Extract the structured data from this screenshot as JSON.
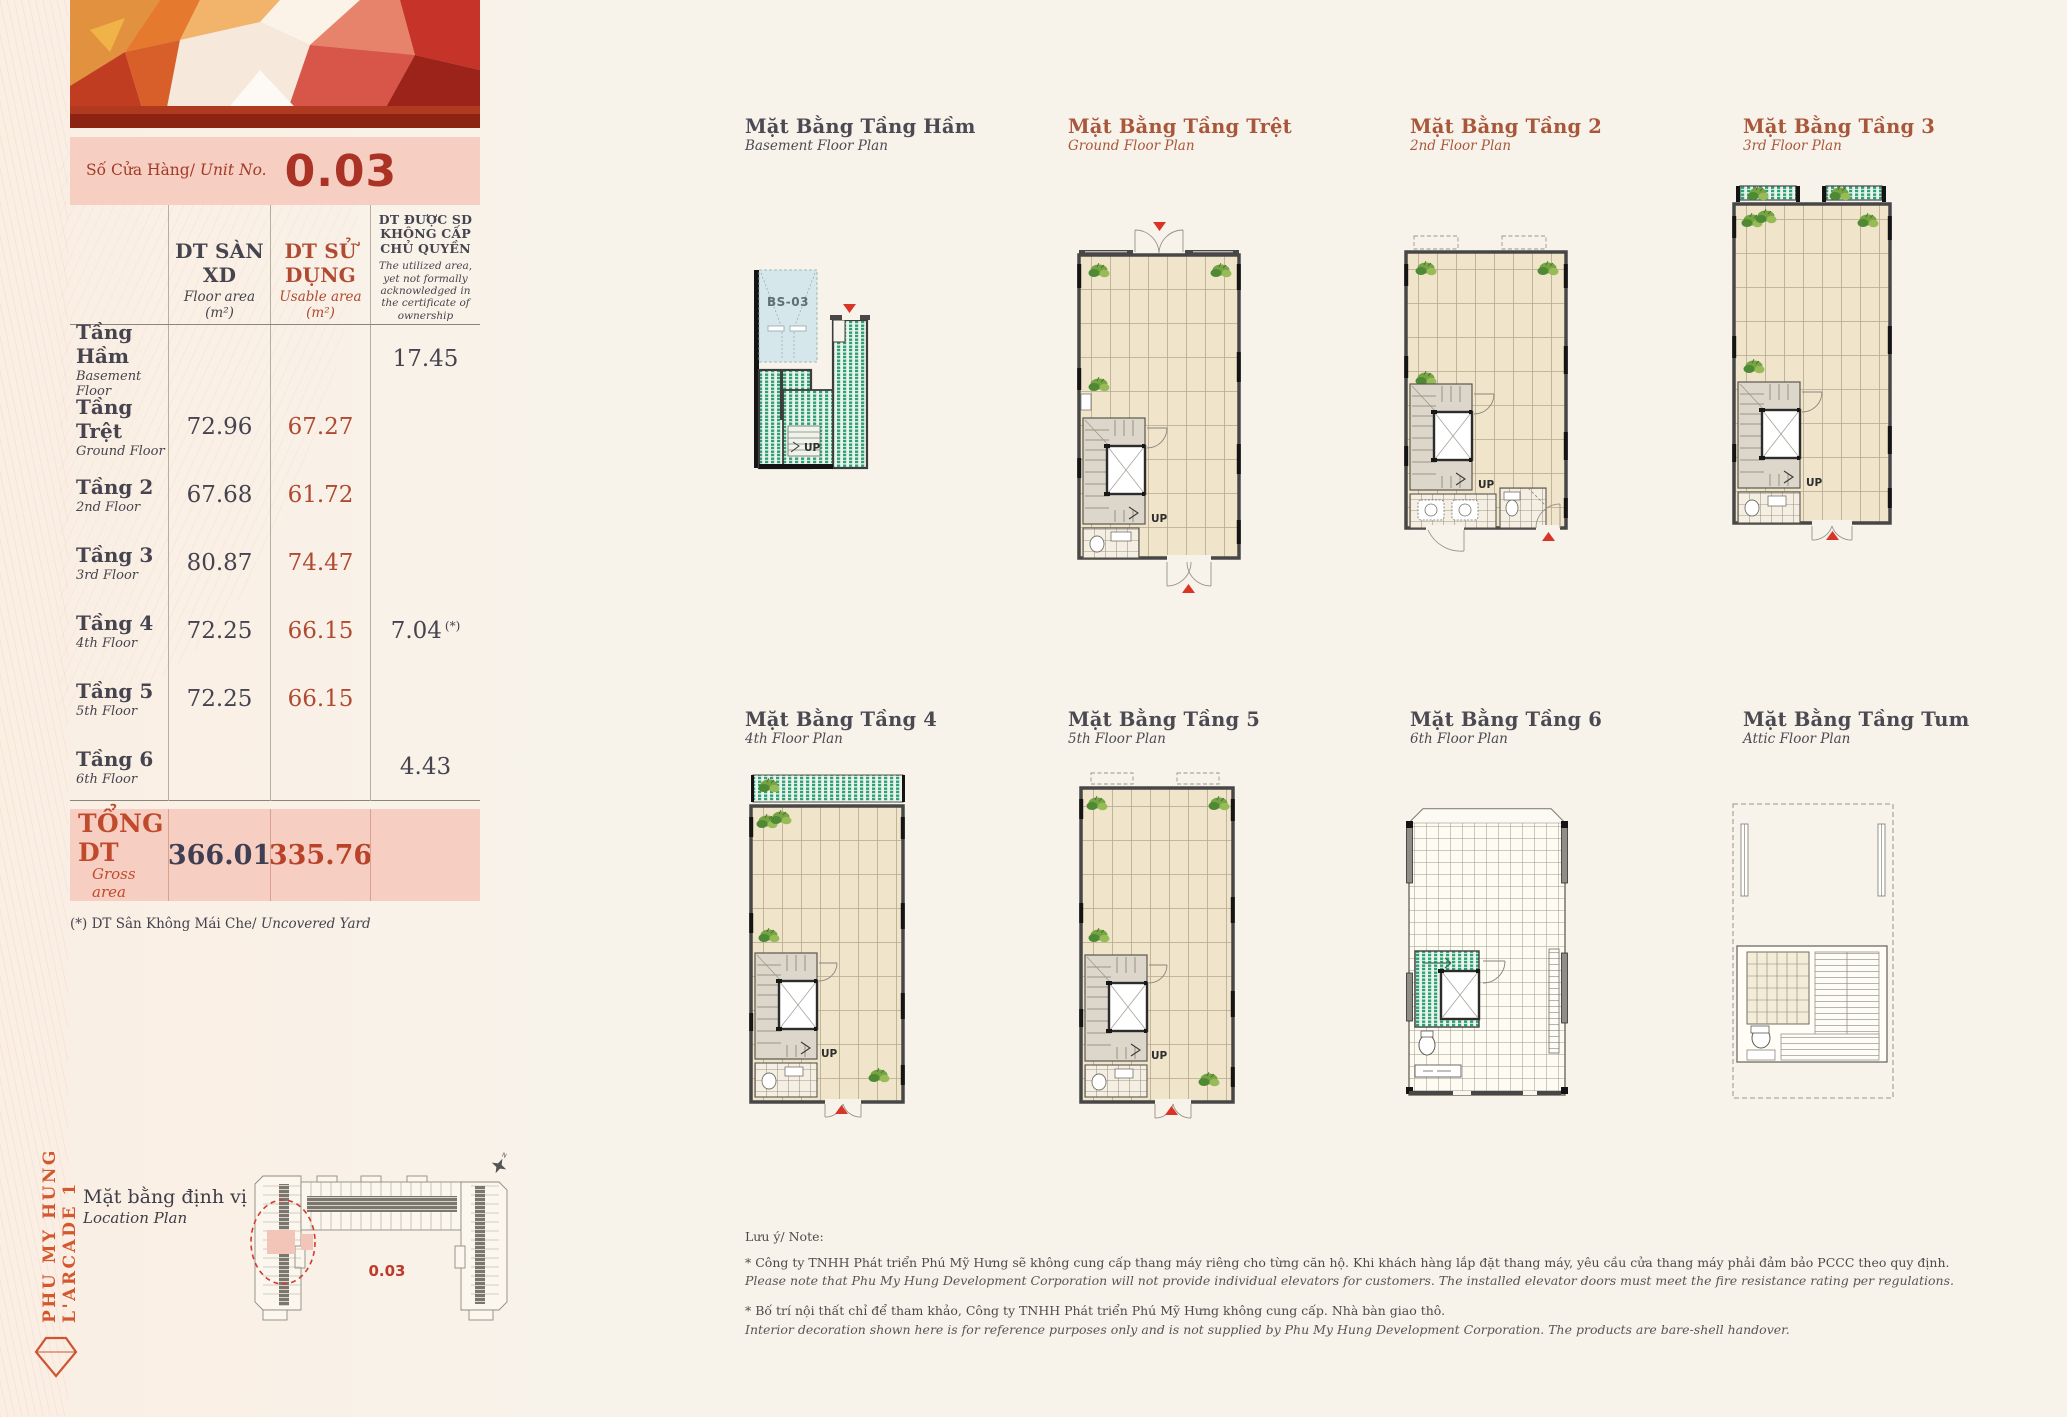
{
  "brand": {
    "vertical_text": "PHU MY HUNG L'ARCADE 1"
  },
  "unit": {
    "label_vi": "Số Cửa Hàng/",
    "label_en": "Unit No.",
    "number": "0.03"
  },
  "table": {
    "columns": {
      "floor_area": {
        "vi": "DT SÀN XD",
        "en": "Floor area (m²)"
      },
      "usable_area": {
        "vi": "DT SỬ DỤNG",
        "en": "Usable area (m²)"
      },
      "uncertified": {
        "vi": "DT ĐƯỢC SD KHÔNG CẤP CHỦ QUYỀN",
        "en": "The utilized area, yet not formally acknowledged in the certificate of ownership"
      }
    },
    "rows": [
      {
        "name_vi": "Tầng Hầm",
        "name_en": "Basement Floor",
        "floor_area": "",
        "usable_area": "",
        "uncertified": "17.45",
        "uncertified_mark": ""
      },
      {
        "name_vi": "Tầng Trệt",
        "name_en": "Ground Floor",
        "floor_area": "72.96",
        "usable_area": "67.27",
        "uncertified": "",
        "uncertified_mark": ""
      },
      {
        "name_vi": "Tầng 2",
        "name_en": "2nd Floor",
        "floor_area": "67.68",
        "usable_area": "61.72",
        "uncertified": "",
        "uncertified_mark": ""
      },
      {
        "name_vi": "Tầng 3",
        "name_en": "3rd Floor",
        "floor_area": "80.87",
        "usable_area": "74.47",
        "uncertified": "",
        "uncertified_mark": ""
      },
      {
        "name_vi": "Tầng 4",
        "name_en": "4th Floor",
        "floor_area": "72.25",
        "usable_area": "66.15",
        "uncertified": "7.04",
        "uncertified_mark": "(*)"
      },
      {
        "name_vi": "Tầng 5",
        "name_en": "5th Floor",
        "floor_area": "72.25",
        "usable_area": "66.15",
        "uncertified": "",
        "uncertified_mark": ""
      },
      {
        "name_vi": "Tầng 6",
        "name_en": "6th Floor",
        "floor_area": "",
        "usable_area": "",
        "uncertified": "4.43",
        "uncertified_mark": ""
      }
    ],
    "total": {
      "label_vi": "TỔNG DT",
      "label_en": "Gross area",
      "floor_area": "366.01",
      "usable_area": "335.76"
    },
    "footnote_vi": "(*) DT Sân Không Mái Che/",
    "footnote_en": "Uncovered Yard"
  },
  "location": {
    "title_vi": "Mặt bằng định vị",
    "title_en": "Location Plan",
    "unit_number": "0.03",
    "north_label": "N"
  },
  "plans": [
    {
      "title": "Mặt Bằng Tầng Hầm",
      "subtitle": "Basement Floor Plan"
    },
    {
      "title": "Mặt Bằng Tầng Trệt",
      "subtitle": "Ground Floor Plan"
    },
    {
      "title": "Mặt Bằng Tầng 2",
      "subtitle": "2nd Floor Plan"
    },
    {
      "title": "Mặt Bằng Tầng 3",
      "subtitle": "3rd Floor Plan"
    },
    {
      "title": "Mặt Bằng Tầng 4",
      "subtitle": "4th Floor Plan"
    },
    {
      "title": "Mặt Bằng Tầng 5",
      "subtitle": "5th Floor Plan"
    },
    {
      "title": "Mặt Bằng Tầng 6",
      "subtitle": "6th Floor Plan"
    },
    {
      "title": "Mặt Bằng Tầng Tum",
      "subtitle": "Attic Floor Plan"
    }
  ],
  "plan_labels": {
    "up": "UP",
    "basement_space": "BS-03"
  },
  "notes": {
    "heading": "Lưu ý/ Note:",
    "items": [
      {
        "vi": "* Công ty TNHH Phát triển Phú Mỹ Hưng sẽ không cung cấp thang máy riêng cho từng căn hộ. Khi khách hàng lắp đặt thang máy, yêu cầu cửa thang máy phải đảm bảo PCCC theo quy định.",
        "en": "Please note that Phu My Hung Development Corporation will not provide individual elevators for customers. The installed elevator doors must meet the fire resistance rating per regulations."
      },
      {
        "vi": "* Bố trí nội thất chỉ để tham khảo, Công ty TNHH Phát triển Phú Mỹ Hưng không cung cấp. Nhà bàn giao thô.",
        "en": "Interior decoration shown here is for reference purposes only and is not supplied by Phu My Hung Development Corporation. The products are bare-shell handover."
      }
    ]
  },
  "colors": {
    "accent_red": "#b8432a",
    "brand_orange": "#d4572e",
    "pink_bar": "#f6cfc2",
    "dark_slate": "#45444f",
    "plan_title_red": "#a9573b",
    "plan_title_dark": "#4b4a52",
    "green_hatch": "#2fa076",
    "floor_beige": "#f0e4cb",
    "marker_red": "#d83427"
  }
}
